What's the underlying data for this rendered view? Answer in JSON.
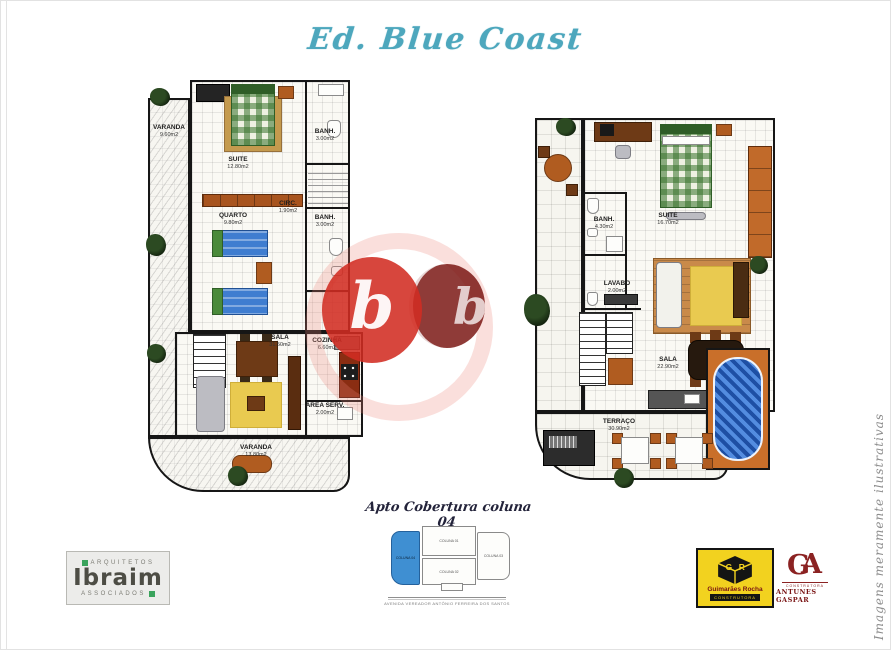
{
  "title": "Ed. Blue Coast",
  "side_watermark": "Imagens meramente ilustrativas",
  "center_watermark": {
    "letter_front": "b",
    "letter_back": "b"
  },
  "plans": {
    "left": {
      "varanda_top": {
        "name": "VARANDA",
        "area": "9.60m2"
      },
      "suite": {
        "name": "SUITE",
        "area": "12.80m2"
      },
      "banh1": {
        "name": "BANH.",
        "area": "3.00m2"
      },
      "circ": {
        "name": "CIRC.",
        "area": "1.90m2"
      },
      "quarto": {
        "name": "QUARTO",
        "area": "9.80m2"
      },
      "banh2": {
        "name": "BANH.",
        "area": "3.00m2"
      },
      "sala": {
        "name": "SALA",
        "area": "31.50m2"
      },
      "cozinha": {
        "name": "COZINHA",
        "area": "6.60m2"
      },
      "area_serv": {
        "name": "ÁREA SERV.",
        "area": "2.00m2"
      },
      "varanda_bottom": {
        "name": "VARANDA",
        "area": "13.80m2"
      }
    },
    "right": {
      "banh": {
        "name": "BANH.",
        "area": "4.30m2"
      },
      "suite": {
        "name": "SUITE",
        "area": "16.70m2"
      },
      "lavabo": {
        "name": "LAVABO",
        "area": "2.00m2"
      },
      "sala": {
        "name": "SALA",
        "area": "22.90m2"
      },
      "terraco": {
        "name": "TERRAÇO",
        "area": "30.90m2"
      }
    }
  },
  "footer": {
    "caption": "Apto Cobertura coluna 04",
    "columns": {
      "c1": "COLUNA 01",
      "c2": "COLUNA 02",
      "c3": "COLUNA 03",
      "c4": "COLUNA 04"
    },
    "address": "AVENIDA VEREADOR ANTÔNIO FERREIRA DOS SANTOS"
  },
  "logos": {
    "ibraim": {
      "top": "ARQUITETOS",
      "name": "Ibraim",
      "bottom": "ASSOCIADOS"
    },
    "guimaraes": {
      "name": "Guimarães Rocha",
      "sub": "CONSTRUTORA"
    },
    "antunes": {
      "monogram_left": "G",
      "monogram_right": "A",
      "sub": "CONSTRUTORA",
      "name": "ANTUNES GASPAR"
    }
  },
  "colors": {
    "accent_teal": "#4da7bd",
    "watermark_red": "#d12c22",
    "pool_blue": "#2e6fd0",
    "highlight_blue": "#3f8fd2",
    "logo_yellow": "#f2d21f",
    "logo_green": "#3aa35c",
    "logo_darkred": "#8b2222"
  }
}
